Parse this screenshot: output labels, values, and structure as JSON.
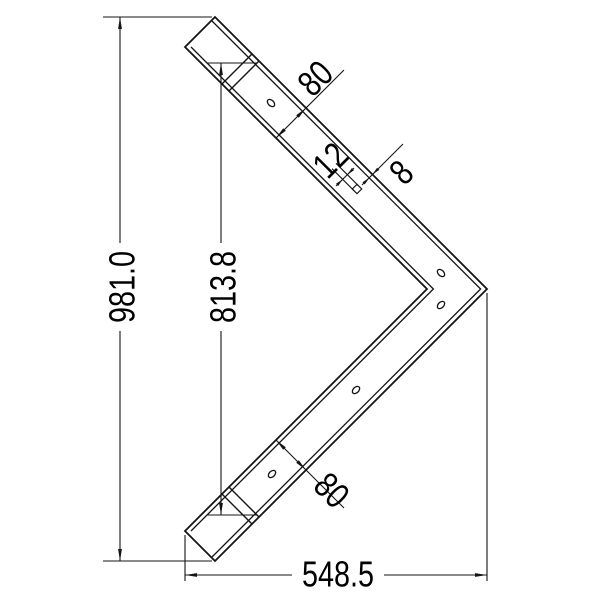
{
  "drawing": {
    "background_color": "#ffffff",
    "line_color": "#141414",
    "view": "2D dimensioned drawing of a V-shaped corner bracket",
    "dimensions": {
      "overall_height": "981.0",
      "inner_length": "813.8",
      "overall_width": "548.5",
      "arm_width_upper": "80",
      "arm_width_lower": "80",
      "square_slot": "12",
      "edge_thickness": "8"
    },
    "features": {
      "round_holes": 5,
      "square_slots": 1,
      "end_caps": 2
    }
  }
}
